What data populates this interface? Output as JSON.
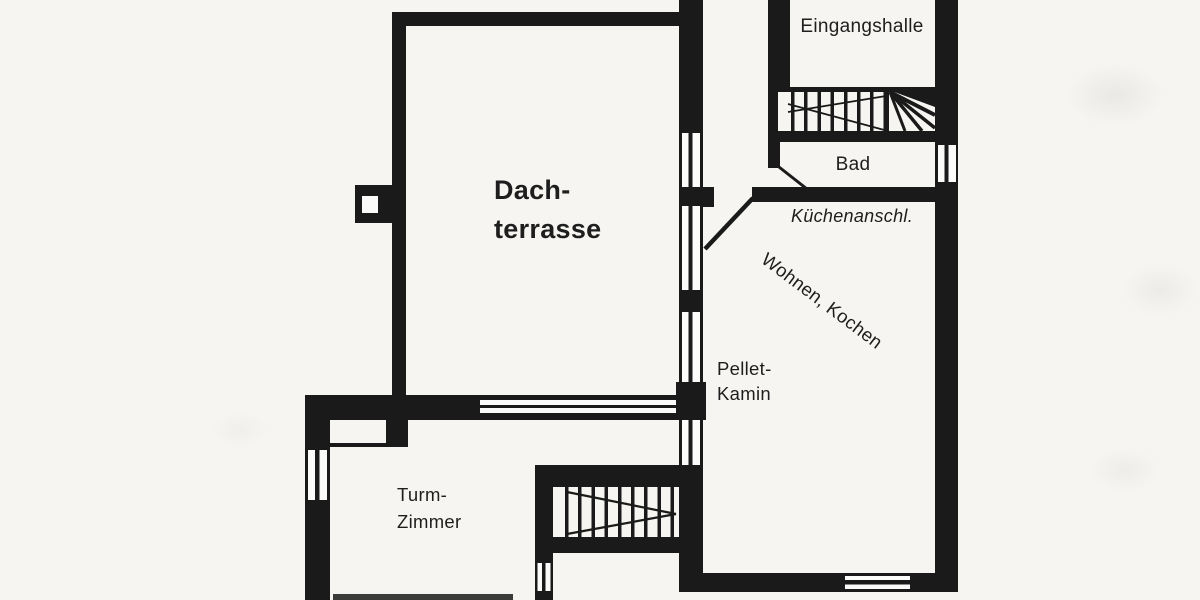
{
  "document": {
    "type": "floor-plan-scan",
    "language": "de"
  },
  "palette": {
    "background": "#f6f5f1",
    "ink": "#1a1a1a"
  },
  "labels": {
    "dachterrasse": {
      "line1": "Dach-",
      "line2": "terrasse"
    },
    "eingangshalle": "Eingangshalle",
    "bad": "Bad",
    "kuechenanschluss": "Küchenanschl.",
    "wohnen_kochen": "Wohnen, Kochen",
    "pellet_kamin": {
      "line1": "Pellet-",
      "line2": "Kamin"
    },
    "turmzimmer": {
      "line1": "Turm-",
      "line2": "Zimmer"
    }
  }
}
